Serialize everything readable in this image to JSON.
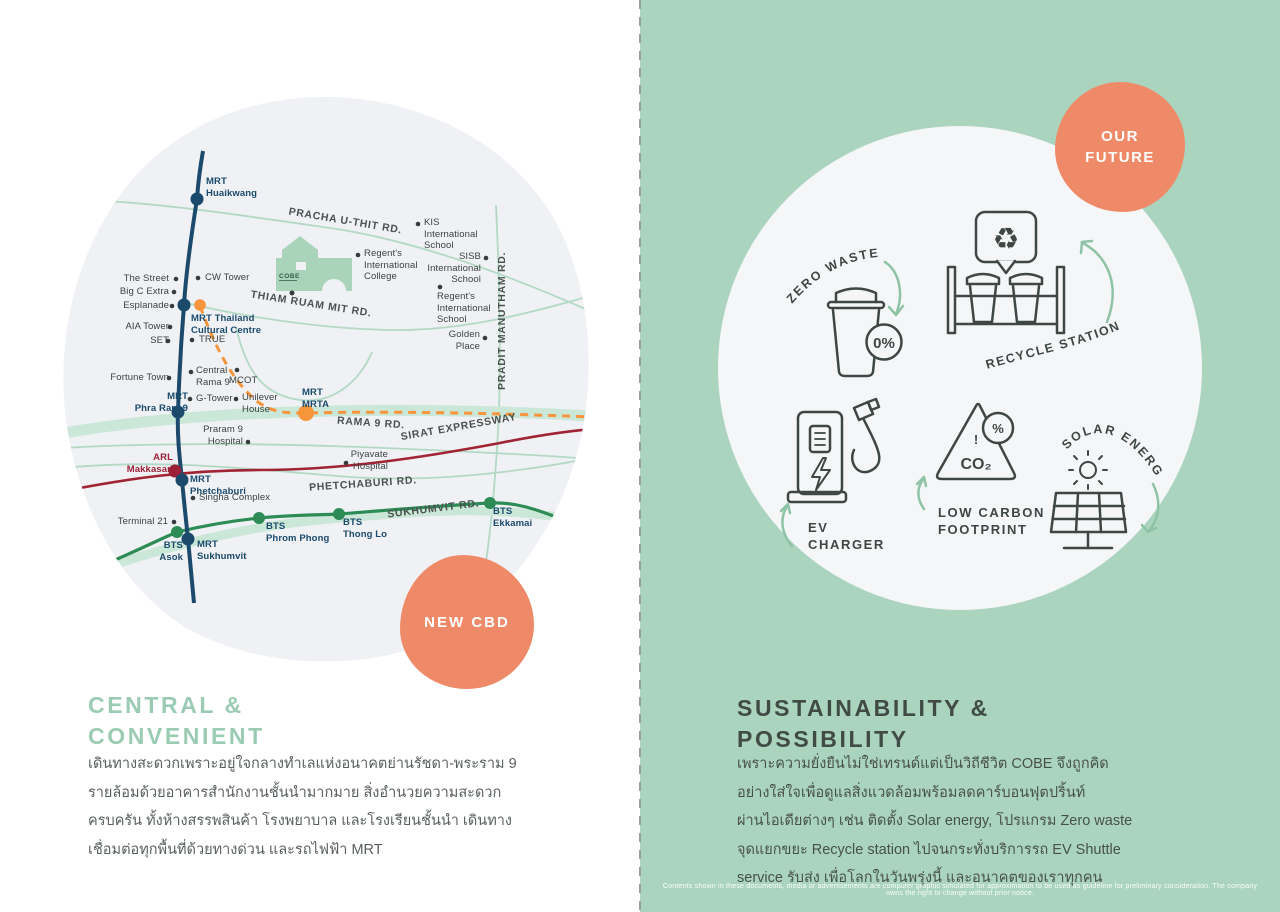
{
  "colors": {
    "panel_green": "#abd4bf",
    "map_blob_gray": "#eff1f4",
    "white_circle": "#f4f6f8",
    "accent_orange": "#ef8a68",
    "mrt_navy": "#1b4a6d",
    "bts_green": "#2d8c55",
    "expressway_red": "#a02433",
    "orange_line": "#f6953c",
    "arl_red": "#9c2036",
    "road_light_green": "#b3d9c5",
    "heading_green": "#9bcbb2",
    "heading_dark": "#404b46",
    "icon_charcoal": "#3e4743",
    "arrow_green": "#8fc3a5"
  },
  "left": {
    "badge": "NEW CBD",
    "heading": "CENTRAL &\nCONVENIENT",
    "body": "เดินทางสะดวกเพราะอยู่ใจกลางทำเลแห่งอนาคตย่านรัชดา-พระราม 9\nรายล้อมด้วยอาคารสำนักงานชั้นนำมากมาย สิ่งอำนวยความสะดวก\nครบครัน ทั้งห้างสรรพสินค้า โรงพยาบาล และโรงเรียนชั้นนำ เดินทาง\nเชื่อมต่อทุกพื้นที่ด้วยทางด่วน และรถไฟฟ้า MRT",
    "map": {
      "building_label": "COBE",
      "stations": {
        "huaikwang": "MRT\nHuaikwang",
        "cultural_centre": "MRT Thailand\nCultural Centre",
        "phra_ram9": "MRT\nPhra Ram 9",
        "mrta": "MRT\nMRTA",
        "phetchaburi": "MRT\nPhetchaburi",
        "sukhumvit": "MRT\nSukhumvit",
        "asok": "BTS\nAsok",
        "phrom_phong": "BTS\nPhrom Phong",
        "thong_lo": "BTS\nThong Lo",
        "ekkamai": "BTS\nEkkamai",
        "makkasan": "ARL\nMakkasan"
      },
      "landmarks": {
        "the_street": "The Street",
        "big_c": "Big C Extra",
        "esplanade": "Esplanade",
        "aia_tower": "AIA Tower",
        "set": "SET",
        "cw_tower": "CW Tower",
        "true_tower": "TRUE",
        "fortune_town": "Fortune Town",
        "central_rama9": "Central\nRama 9",
        "mcot": "MCOT",
        "g_tower": "G-Tower",
        "unilever": "Unilever\nHouse",
        "praram9_hospital": "Praram 9\nHospital",
        "piyavate": "Piyavate\nHospital",
        "singha": "Singha Complex",
        "terminal21": "Terminal 21",
        "kis": "KIS\nInternational\nSchool",
        "sisb": "SISB\nInternational\nSchool",
        "regents_college": "Regent's\nInternational\nCollege",
        "regents_school": "Regent's\nInternational\nSchool",
        "golden_place": "Golden\nPlace"
      },
      "roads": {
        "pracha": "PRACHA U-THIT RD.",
        "thiam": "THIAM RUAM MIT RD.",
        "rama9": "RAMA 9 RD.",
        "sirat": "SIRAT EXPRESSWAY",
        "phetchaburi_rd": "PHETCHABURI RD.",
        "sukhumvit_rd": "SUKHUMVIT RD.",
        "pradit": "PRADIT MANUTHAM RD."
      }
    }
  },
  "right": {
    "badge": "OUR\nFUTURE",
    "heading": "SUSTAINABILITY &\nPOSSIBILITY",
    "body": "เพราะความยั่งยืนไม่ใช่เทรนด์แต่เป็นวิถีชีวิต COBE จึงถูกคิด\nอย่างใส่ใจเพื่อดูแลสิ่งแวดล้อมพร้อมลดคาร์บอนฟุตปริ้นท์\nผ่านไอเดียต่างๆ เช่น ติดตั้ง Solar energy, โปรแกรม Zero waste\nจุดแยกขยะ Recycle station ไปจนกระทั่งบริการรถ EV Shuttle\nservice รับส่ง เพื่อโลกในวันพรุ่งนี้ และอนาคตของเราทุกคน",
    "icons": {
      "zero_waste": "ZERO WASTE",
      "zero_badge": "0%",
      "recycle_station": "RECYCLE STATION",
      "recycle_glyph": "♻",
      "ev_charger": "EV\nCHARGER",
      "low_carbon": "LOW CARBON\nFOOTPRINT",
      "co2": "CO₂",
      "co2_mark": "!",
      "percent": "%",
      "solar": "SOLAR ENERGY"
    },
    "disclaimer": "Contents shown in these documents, media or advertisements are computer graphic simulated for approximation to be used as guideline for preliminary consideration. The company owns the right to change without prior notice."
  }
}
